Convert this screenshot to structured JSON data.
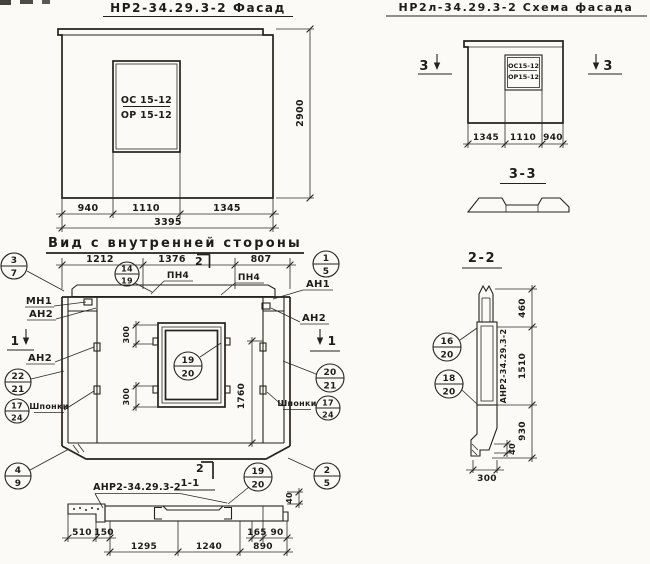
{
  "drawing": {
    "facade": {
      "title": "НР2-34.29.3-2  Фасад",
      "window_top": "ОС 15-12",
      "window_bottom": "ОР 15-12",
      "dims": {
        "d940": "940",
        "d1110": "1110",
        "d1345": "1345",
        "total": "3395",
        "height": "2900"
      }
    },
    "schema": {
      "title": "НР2л-34.29.3-2  Схема фасада",
      "window_top": "ОС15-12",
      "window_bottom": "ОР15-12",
      "marker_left": "3",
      "marker_right": "3",
      "dims": {
        "d1345": "1345",
        "d1110": "1110",
        "d940": "940"
      }
    },
    "inner": {
      "title": "Вид с внутренней стороны",
      "dims": {
        "d1212": "1212",
        "d1376": "1376",
        "d807": "807",
        "d300a": "300",
        "d300b": "300",
        "d1760": "1760",
        "d40": "40"
      },
      "labels": {
        "pn4a": "ПН4",
        "pn4b": "ПН4",
        "mn1": "МН1",
        "an1": "АН1",
        "an2a": "АН2",
        "an2b": "АН2",
        "an2c": "АН2",
        "keys_left": "Шпонки",
        "keys_right": "Шпонки",
        "mark": "АНР2-34.29.3-2"
      },
      "markers": {
        "cut2": "2",
        "cut1_left": "1",
        "cut1_right": "1",
        "bottom_cut2": "2"
      },
      "callouts": {
        "c3_7": {
          "t": "3",
          "b": "7"
        },
        "c1_5": {
          "t": "1",
          "b": "5"
        },
        "c14_19": {
          "t": "14",
          "b": "19"
        },
        "c22_21": {
          "t": "22",
          "b": "21"
        },
        "c17_24_left": {
          "t": "17",
          "b": "24"
        },
        "c19_20": {
          "t": "19",
          "b": "20"
        },
        "c20_21": {
          "t": "20",
          "b": "21"
        },
        "c17_24_right": {
          "t": "17",
          "b": "24"
        },
        "c4_9": {
          "t": "4",
          "b": "9"
        },
        "c19_20_bottom": {
          "t": "19",
          "b": "20"
        },
        "c2_5": {
          "t": "2",
          "b": "5"
        }
      }
    },
    "section11": {
      "title": "1-1",
      "dims": {
        "d510": "510",
        "d150": "150",
        "d1295": "1295",
        "d1240": "1240",
        "d890": "890",
        "d165": "165",
        "d90": "90"
      }
    },
    "section22": {
      "title": "2-2",
      "mark": "АНР2-34.29.3-2",
      "callouts": {
        "c16_20": {
          "t": "16",
          "b": "20"
        },
        "c18_20": {
          "t": "18",
          "b": "20"
        }
      },
      "dims": {
        "d460": "460",
        "d1510": "1510",
        "d930": "930",
        "d40": "40",
        "d300": "300"
      }
    },
    "section33": {
      "title": "3-3"
    }
  }
}
